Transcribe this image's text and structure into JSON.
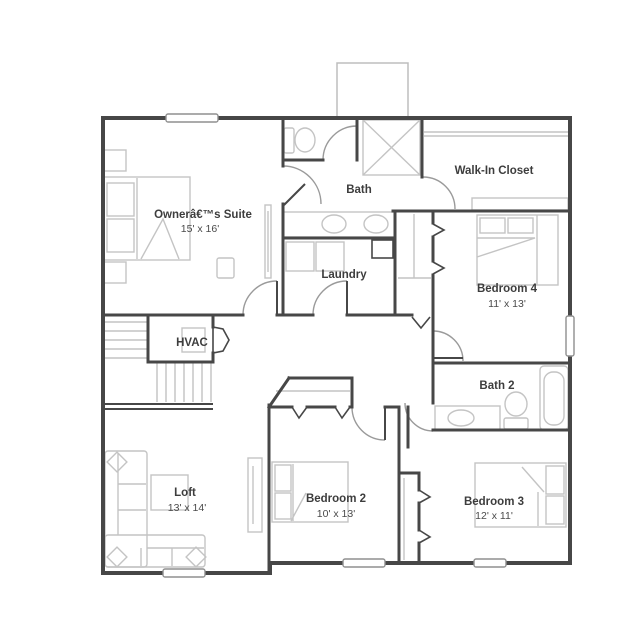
{
  "floor_plan": {
    "rooms": [
      {
        "id": "owners-suite",
        "name": "Ownerâ€™s Suite",
        "dims": "15' x 16'"
      },
      {
        "id": "bath",
        "name": "Bath",
        "dims": ""
      },
      {
        "id": "walk-in-closet",
        "name": "Walk-In Closet",
        "dims": ""
      },
      {
        "id": "laundry",
        "name": "Laundry",
        "dims": ""
      },
      {
        "id": "bedroom-4",
        "name": "Bedroom 4",
        "dims": "11' x 13'"
      },
      {
        "id": "hvac",
        "name": "HVAC",
        "dims": ""
      },
      {
        "id": "bath-2",
        "name": "Bath 2",
        "dims": ""
      },
      {
        "id": "loft",
        "name": "Loft",
        "dims": "13' x 14'"
      },
      {
        "id": "bedroom-2",
        "name": "Bedroom 2",
        "dims": "10' x 13'"
      },
      {
        "id": "bedroom-3",
        "name": "Bedroom 3",
        "dims": "12' x 11'"
      }
    ],
    "colors": {
      "wall": "#474747",
      "fixture": "#c4c4c4",
      "door_arc": "#9a9a9a",
      "label": "#3d3d3d",
      "background": "#ffffff"
    }
  }
}
